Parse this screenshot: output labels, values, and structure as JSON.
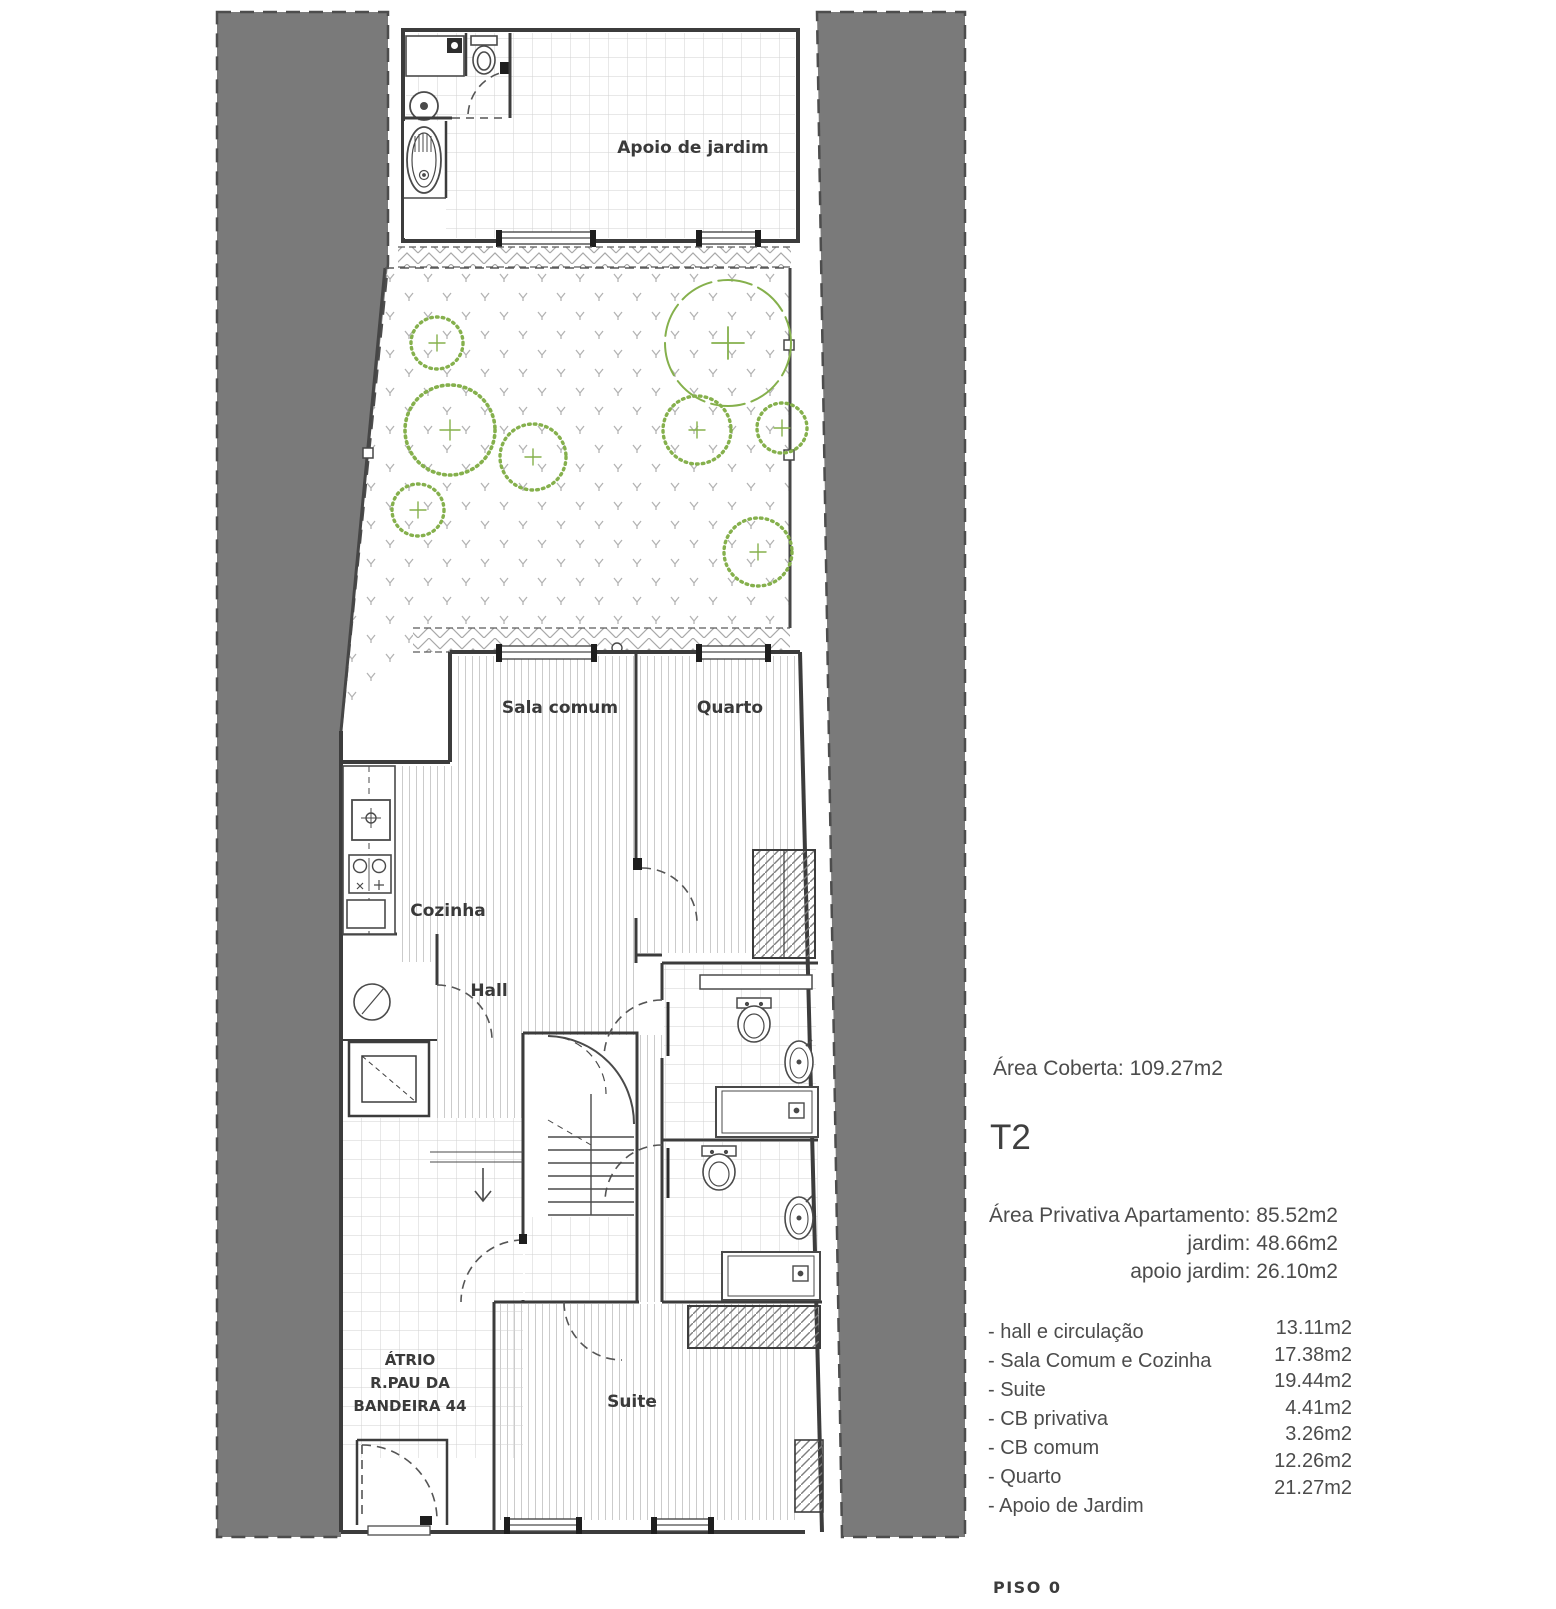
{
  "plan": {
    "rooms": {
      "apoio_jardim": "Apoio de jardim",
      "sala_comum": "Sala comum",
      "quarto": "Quarto",
      "cozinha": "Cozinha",
      "hall": "Hall",
      "suite": "Suite",
      "atrio_line1": "ÁTRIO",
      "atrio_line2": "R.PAU DA",
      "atrio_line3": "BANDEIRA 44"
    },
    "colors": {
      "site_gray": "#7a7a7a",
      "wall": "#3c3c3c",
      "vegetation_green": "#85b04c"
    }
  },
  "info": {
    "area_coberta": "Área Coberta: 109.27m2",
    "unit_type": "T2",
    "private_areas": [
      "Área Privativa Apartamento: 85.52m2",
      "jardim: 48.66m2",
      "apoio jardim:  26.10m2"
    ],
    "room_areas": [
      {
        "label": "- hall e circulação",
        "value": "13.11m2"
      },
      {
        "label": "- Sala Comum e Cozinha",
        "value": "17.38m2"
      },
      {
        "label": "- Suite",
        "value": "19.44m2"
      },
      {
        "label": "- CB privativa",
        "value": "4.41m2"
      },
      {
        "label": "- CB comum",
        "value": "3.26m2"
      },
      {
        "label": "- Quarto",
        "value": "12.26m2"
      },
      {
        "label": "- Apoio de Jardim",
        "value": "21.27m2"
      }
    ],
    "floor_label": "PISO 0"
  }
}
